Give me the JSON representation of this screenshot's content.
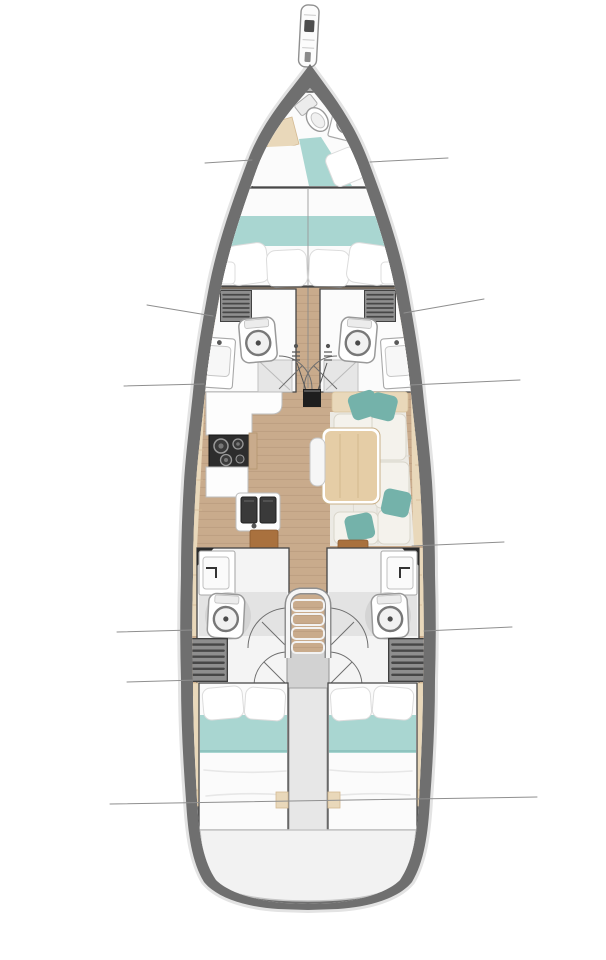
{
  "diagram": {
    "type": "sailboat-interior-deck-plan",
    "orientation": "bow-at-top",
    "regions": [
      "bowsprit",
      "bow-crew-head",
      "bow-crew-berth",
      "forward-owner-cabin",
      "port-forward-head",
      "starboard-forward-head",
      "galley",
      "salon",
      "mast",
      "companionway-stairs",
      "engine-compartment",
      "port-aft-head",
      "starboard-aft-head",
      "port-aft-cabin",
      "starboard-aft-cabin",
      "swim-platform"
    ],
    "features": {
      "galley": [
        "l-shaped-counter",
        "three-burner-stove",
        "double-sink",
        "hull-side-lockers",
        "nav-seat"
      ],
      "salon": [
        "u-shaped-sofa",
        "dining-table",
        "teal-accent-pillows",
        "aisle-stool",
        "chart-desk"
      ],
      "heads": [
        "toilet",
        "wash-basin",
        "shower",
        "louvered-locker"
      ],
      "cabins": [
        "double-berth",
        "pillows",
        "teal-bed-runner"
      ]
    }
  },
  "colors": {
    "page-bg": "#ffffff",
    "hull": "#6f6f6f",
    "halo": "#e3e3e3",
    "interior": "#fbfaf7",
    "wood": "#c9ab8c",
    "wood-line": "#b6987a",
    "outline": "#454545",
    "line": "#8f8f8f",
    "teal": "#a9d6d1",
    "teal-dark": "#74b2aa",
    "beige": "#e9d8ba",
    "beige-line": "#d3ba94",
    "white-soft": "#fbfbfb",
    "gray-floor": "#e3e3e3",
    "locker": "#8e8e8e",
    "locker-slat": "#474747",
    "stove": "#2d2d2d",
    "metal-sink": "#3a3a3a",
    "engine": "#d2d2d2",
    "column": "#e7e7e7",
    "platform": "#f2f2f2",
    "platform-edge": "#c6c6c6",
    "table": "#e5cda6",
    "table-edge": "#c9b089",
    "brown": "#a9713e",
    "deck-a": "#b5b5b5",
    "deck-b": "#878787",
    "mast": "#1e1e1e",
    "pillow-edge": "#dcdcdc",
    "shadow": "#d4d4d4"
  }
}
